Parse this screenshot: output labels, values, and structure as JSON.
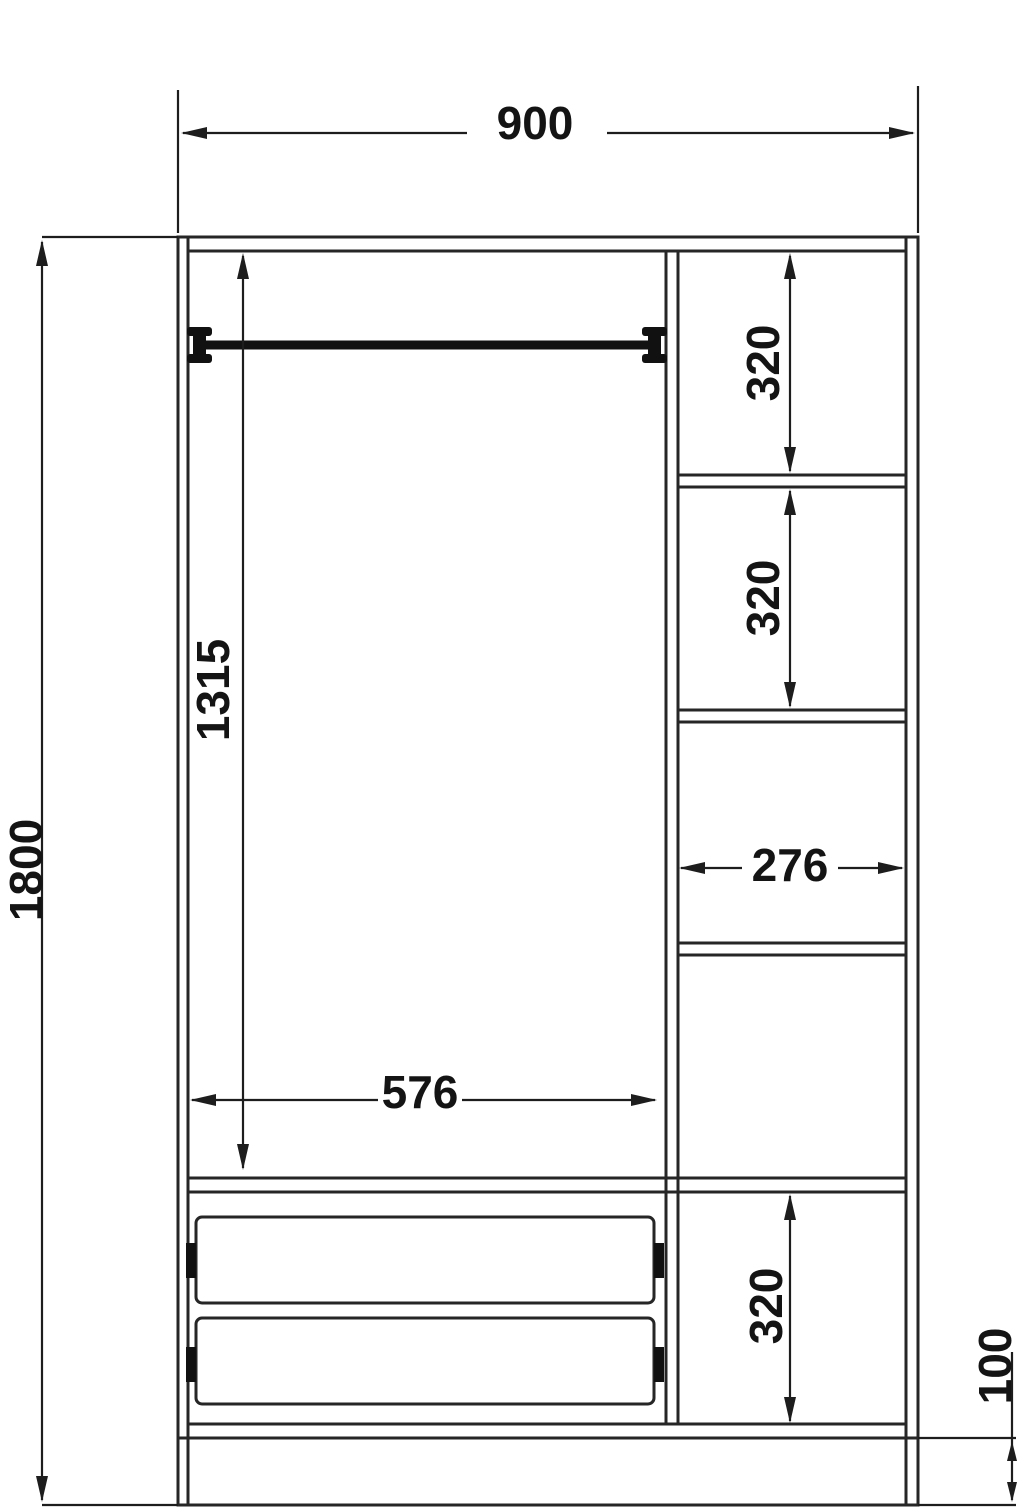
{
  "dimensions": {
    "overall_width": "900",
    "overall_height": "1800",
    "hanging_section_height": "1315",
    "hanging_section_width": "576",
    "shelf_compartment_1_height": "320",
    "shelf_compartment_2_height": "320",
    "shelf_column_width": "276",
    "bottom_compartment_height": "320",
    "plinth_height": "100"
  },
  "colors": {
    "line": "#262626",
    "dimension_line": "#1d1d1d",
    "fitting": "#111111",
    "background": "#ffffff"
  }
}
